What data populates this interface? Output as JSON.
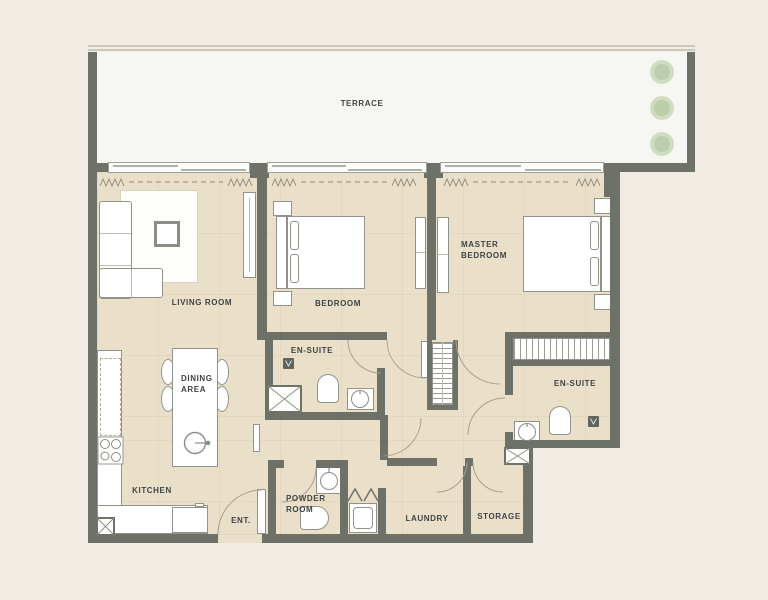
{
  "plan_labels": {
    "terrace": "TERRACE",
    "living_room": "LIVING ROOM",
    "bedroom": "BEDROOM",
    "master_bedroom": "MASTER BEDROOM",
    "ensuite_bedroom": "EN-SUITE",
    "ensuite_master": "EN-SUITE",
    "dining_area": "DINING AREA",
    "kitchen": "KITCHEN",
    "entrance": "ENT.",
    "powder_room": "POWDER ROOM",
    "laundry": "LAUNDRY",
    "storage": "STORAGE"
  },
  "colors": {
    "background": "#f1ebe3",
    "terrace_floor": "#f6f6f3",
    "apartment_floor": "#eae0ca",
    "wall": "#6d7168",
    "label_text": "#3f4345",
    "furniture_outline": "#8f938a",
    "tree_green": "#bccfa9",
    "door_swing": "#a79f8e"
  }
}
